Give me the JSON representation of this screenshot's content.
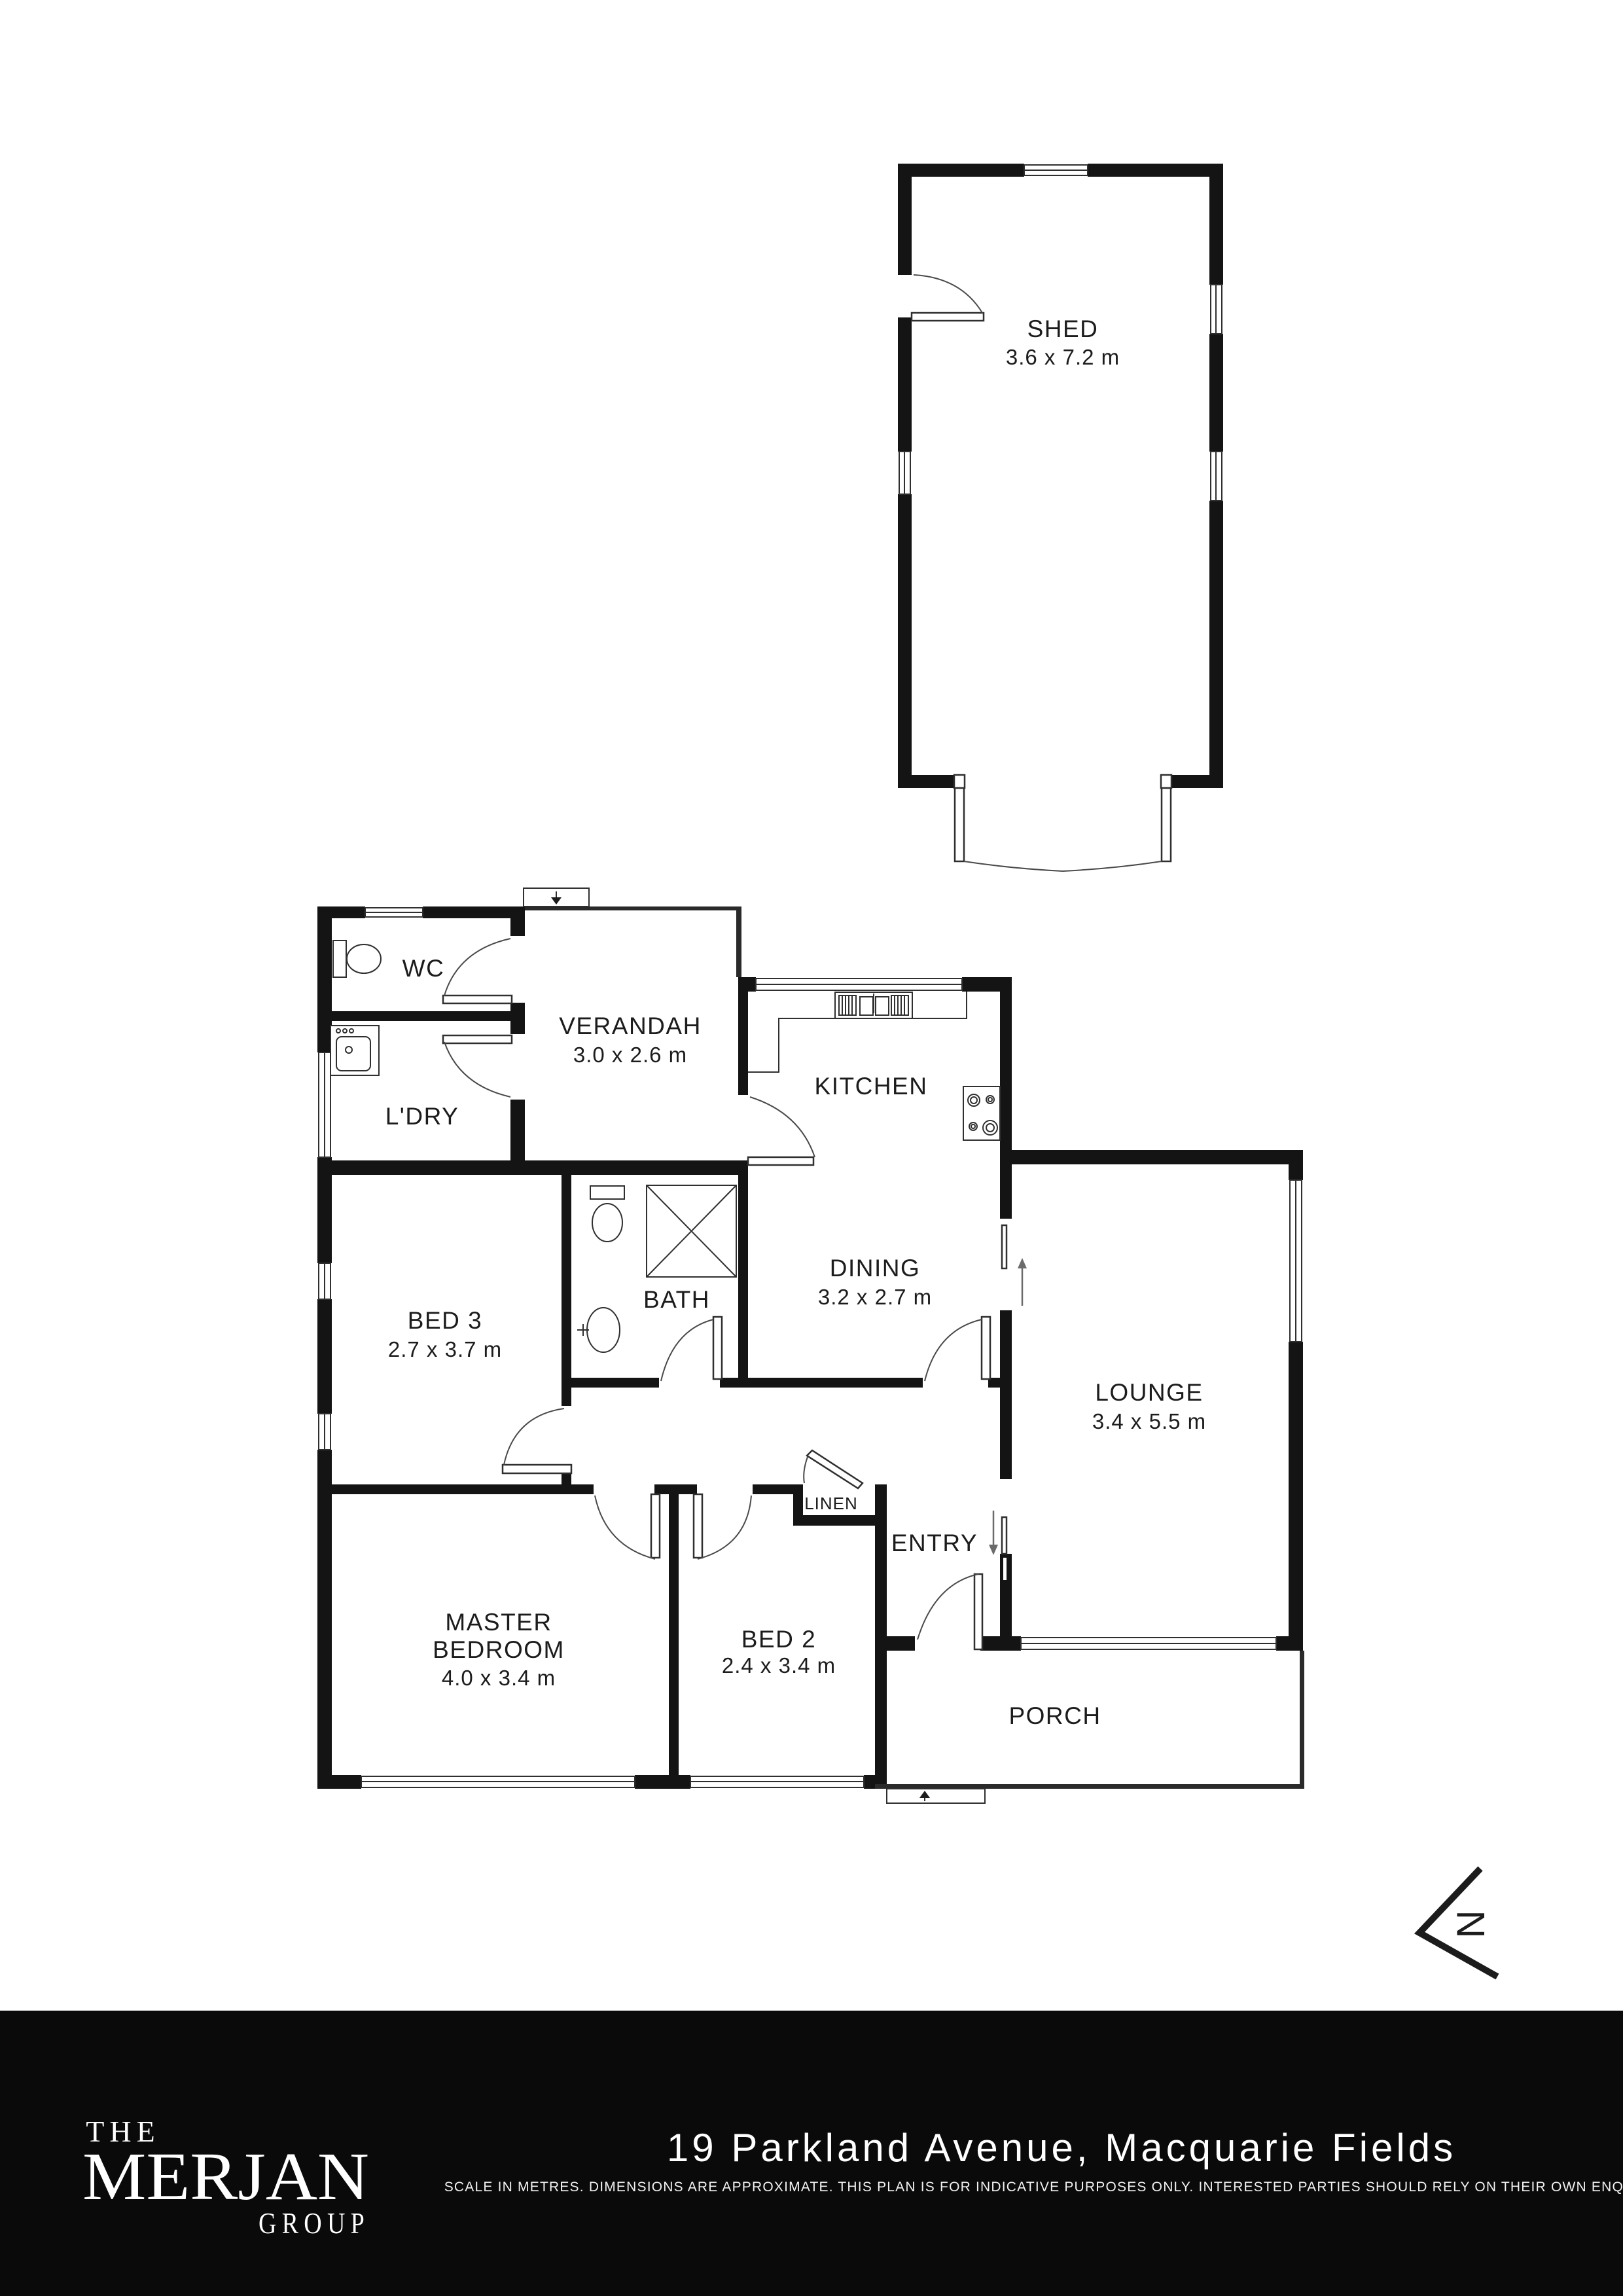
{
  "plan": {
    "rooms": {
      "shed": {
        "name": "SHED",
        "dims": "3.6 x 7.2 m"
      },
      "wc": {
        "name": "WC"
      },
      "verandah": {
        "name": "VERANDAH",
        "dims": "3.0 x 2.6 m"
      },
      "ldry": {
        "name": "L'DRY"
      },
      "kitchen": {
        "name": "KITCHEN"
      },
      "dining": {
        "name": "DINING",
        "dims": "3.2 x 2.7 m"
      },
      "bath": {
        "name": "BATH"
      },
      "bed3": {
        "name": "BED 3",
        "dims": "2.7 x 3.7 m"
      },
      "lounge": {
        "name": "LOUNGE",
        "dims": "3.4 x 5.5 m"
      },
      "master": {
        "line1": "MASTER",
        "line2": "BEDROOM",
        "dims": "4.0 x 3.4 m"
      },
      "bed2": {
        "name": "BED 2",
        "dims": "2.4 x 3.4 m"
      },
      "entry": {
        "name": "ENTRY"
      },
      "linen": {
        "name": "LINEN"
      },
      "porch": {
        "name": "PORCH"
      }
    },
    "north_letter": "N",
    "colors": {
      "wall": "#141414",
      "accent_bg": "#0a0a0a",
      "text": "#1c1c1c"
    }
  },
  "icons": {
    "north": "chevron-north-icon",
    "entry_steps": [
      "step-arrow-down-icon",
      "step-arrow-up-icon"
    ],
    "fixtures": [
      "toilet-icon",
      "laundry-sink-icon",
      "shower-icon",
      "basin-icon",
      "kitchen-sink-icon",
      "stove-icon"
    ]
  },
  "footer": {
    "brand": {
      "line1": "THE",
      "line2": "MERJAN",
      "line3": "GROUP"
    },
    "address": "19 Parkland Avenue, Macquarie Fields",
    "disclaimer": "SCALE IN METRES. DIMENSIONS ARE APPROXIMATE. THIS PLAN IS FOR INDICATIVE PURPOSES ONLY. INTERESTED PARTIES SHOULD RELY ON THEIR OWN ENQUIRIES."
  }
}
